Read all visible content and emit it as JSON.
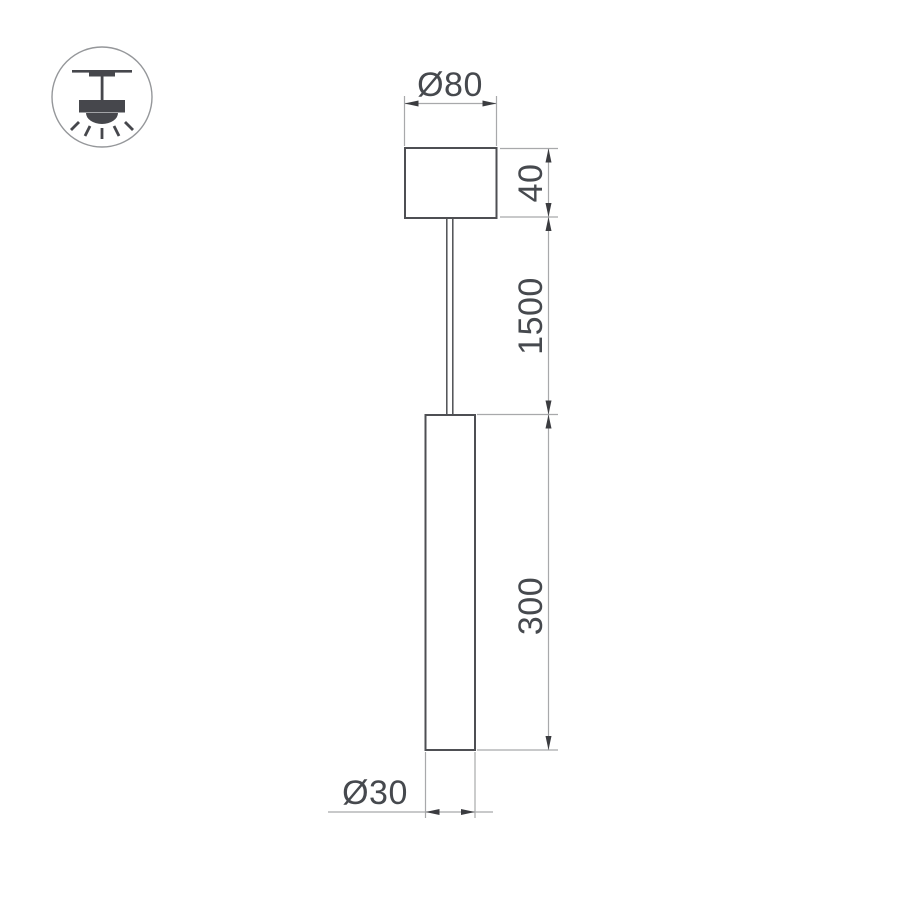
{
  "drawing": {
    "type": "pendant-luminaire-dimension-drawing",
    "labels": {
      "canopy_diameter": "Ø80",
      "canopy_height": "40",
      "suspension_length": "1500",
      "tube_length": "300",
      "tube_diameter": "Ø30"
    },
    "measurements": {
      "canopy_diameter_mm": 80,
      "canopy_height_mm": 40,
      "suspension_length_mm": 1500,
      "tube_length_mm": 300,
      "tube_diameter_mm": 30
    }
  },
  "icon": {
    "name": "ceiling-pendant-mount",
    "fill": "#46474c",
    "circle_stroke": "#95979a"
  },
  "colors": {
    "background": "#ffffff",
    "outline": "#4e4f53",
    "dim_line": "#a8a9ab",
    "arrow": "#3b3c40",
    "text": "#46494e"
  }
}
